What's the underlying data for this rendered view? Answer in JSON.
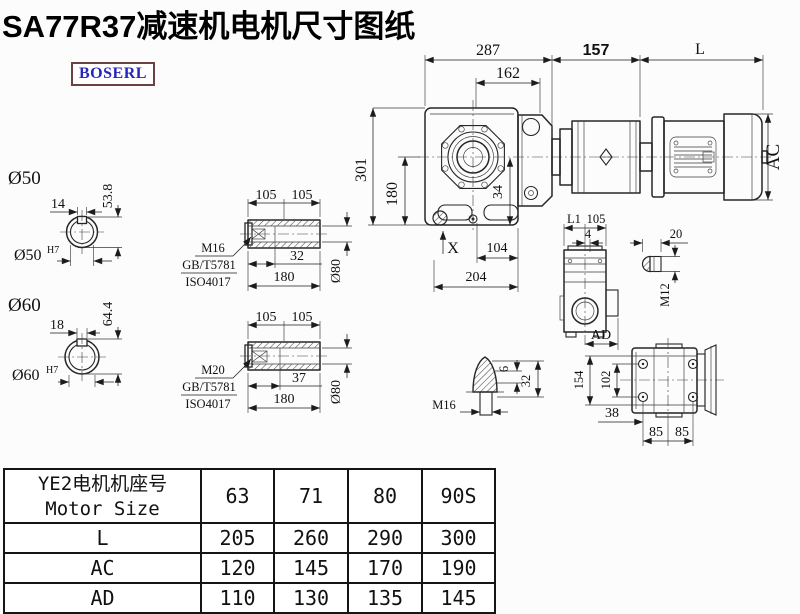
{
  "title": "SA77R37减速机电机尺寸图纸",
  "logo": "BOSERL",
  "main_view": {
    "d287": "287",
    "d162": "162",
    "d157": "157",
    "dL": "L",
    "d301": "301",
    "d180": "180",
    "d34": "34",
    "dX": "X",
    "d104": "104",
    "d204": "204",
    "dAC": "AC"
  },
  "section50": {
    "label": "Ø50",
    "key_w": "14",
    "key_h": "53.8",
    "bore": "Ø50",
    "tol": "H7"
  },
  "section60": {
    "label": "Ø60",
    "key_w": "18",
    "key_h": "64.4",
    "bore": "Ø60",
    "tol": "H7"
  },
  "shaft16": {
    "d105a": "105",
    "d105b": "105",
    "depth": "32",
    "len": "180",
    "dia": "Ø80",
    "thread": "M16",
    "std": "GB/T5781",
    "iso": "ISO4017"
  },
  "shaft20": {
    "d105a": "105",
    "d105b": "105",
    "depth": "37",
    "len": "180",
    "dia": "Ø80",
    "thread": "M20",
    "std": "GB/T5781",
    "iso": "ISO4017"
  },
  "side_view": {
    "dL1": "L1",
    "d105": "105",
    "d4": "4",
    "dAD": "AD"
  },
  "pin": {
    "d20": "20",
    "thread": "M12"
  },
  "breather": {
    "d6": "6",
    "d32": "32",
    "thread": "M16"
  },
  "rear": {
    "d154": "154",
    "d102": "102",
    "d38": "38",
    "d85a": "85",
    "d85b": "85"
  },
  "table": {
    "header_cn": "YE2电机机座号",
    "header_en": "Motor Size",
    "sizes": [
      "63",
      "71",
      "80",
      "90S"
    ],
    "rows": [
      {
        "label": "L",
        "values": [
          "205",
          "260",
          "290",
          "300"
        ]
      },
      {
        "label": "AC",
        "values": [
          "120",
          "145",
          "170",
          "190"
        ]
      },
      {
        "label": "AD",
        "values": [
          "110",
          "130",
          "135",
          "145"
        ]
      }
    ]
  }
}
